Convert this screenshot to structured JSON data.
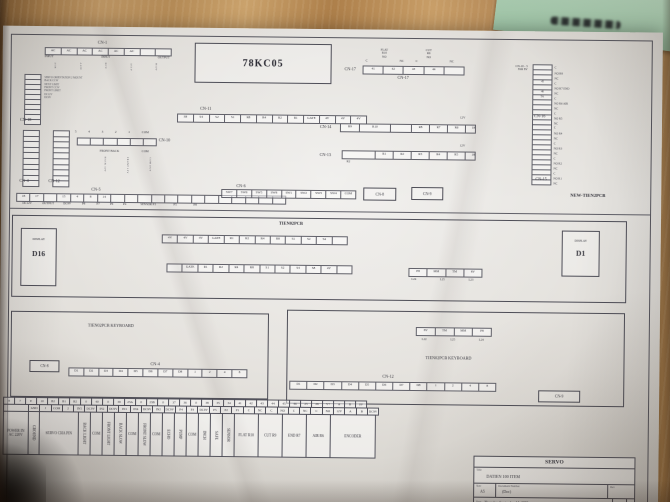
{
  "top": {
    "cn1": {
      "label": "CN-1",
      "cells": [
        "AC",
        "AC",
        "AC",
        "AC",
        "AC",
        "AC",
        "",
        ""
      ],
      "groups": [
        "INPUT",
        "INPUT",
        "OUTPUT"
      ],
      "pins": [
        "ACB",
        "A12V",
        "BCV",
        "AC1V",
        "B12V"
      ]
    },
    "chip": "78KC05",
    "cn18": {
      "label": "CN-18",
      "rows": [
        "",
        "",
        "",
        "",
        "",
        "",
        "",
        "",
        "",
        ""
      ],
      "notes": [
        "SERVO ORIENTATION 2 MOUNT",
        "BACK CCW",
        "NEXT LIMIT",
        "FRONT CCW",
        "FRONT LIMIT",
        "DC12V",
        "DC9V"
      ]
    },
    "cn17": {
      "label_left": "CN-17",
      "label_below": "CN-17",
      "c1": "C",
      "nc1": "NC",
      "c2": "C",
      "nc2": "NC",
      "flat": [
        "FLAT",
        "R10",
        "NO"
      ],
      "cut": [
        "CUT",
        "R6",
        "NO"
      ],
      "cells": [
        "41",
        "42",
        "43",
        "44",
        ""
      ]
    },
    "ssr": [
      "CN-10 - 3",
      "SSR 8V"
    ],
    "cn16": {
      "label": "CN-16",
      "items": [
        {
          "c": "",
          "p": "C"
        },
        {
          "c": "",
          "p": "NO R8"
        },
        {
          "c": "",
          "p": "NC"
        },
        {
          "c": "45",
          "p": "C"
        },
        {
          "c": "",
          "p": "NO R7  END"
        },
        {
          "c": "46",
          "p": "NC"
        },
        {
          "c": "5A",
          "p": "C"
        },
        {
          "c": "",
          "p": "NO R6  AIR"
        },
        {
          "c": "",
          "p": "NC"
        },
        {
          "c": "",
          "p": "C"
        },
        {
          "c": "",
          "p": "NO R5"
        },
        {
          "c": "",
          "p": "NC"
        }
      ]
    },
    "cn15": {
      "label": "CN-15",
      "items": [
        {
          "c": "",
          "p": "C"
        },
        {
          "c": "",
          "p": "NO R4"
        },
        {
          "c": "",
          "p": "NC"
        },
        {
          "c": "",
          "p": "C"
        },
        {
          "c": "",
          "p": "NO R3"
        },
        {
          "c": "",
          "p": "NC"
        },
        {
          "c": "",
          "p": "C"
        },
        {
          "c": "",
          "p": "NO R2"
        },
        {
          "c": "",
          "p": "NC"
        },
        {
          "c": "",
          "p": "C"
        },
        {
          "c": "",
          "p": "NO R1"
        },
        {
          "c": "",
          "p": "NC"
        }
      ]
    },
    "cn11": {
      "label": "CN-11",
      "cells": [
        "S8",
        "S4",
        "S2",
        "S1",
        "R8",
        "R4",
        "R2",
        "R1",
        "GATE",
        "4V",
        "4V",
        "4V"
      ]
    },
    "cn14": {
      "label": "CN-14",
      "v": "12V",
      "cells": [
        {
          "t": "R9",
          "w": 18
        },
        {
          "t": "R10",
          "w": 30
        },
        {
          "t": "",
          "w": 20
        },
        {
          "t": "R8",
          "w": 17
        },
        {
          "t": "R7",
          "w": 17
        },
        {
          "t": "R6",
          "w": 17
        },
        {
          "t": "18",
          "w": 15
        }
      ]
    },
    "cn13": {
      "label": "CN-13",
      "v": "12V",
      "sub": "R2",
      "cells": [
        {
          "t": "",
          "w": 32
        },
        {
          "t": "R1",
          "w": 17
        },
        {
          "t": "R2",
          "w": 17
        },
        {
          "t": "R3",
          "w": 17
        },
        {
          "t": "R4",
          "w": 17
        },
        {
          "t": "R5",
          "w": 17
        },
        {
          "t": "18",
          "w": 15
        }
      ]
    },
    "cn10": {
      "label": "CN-10",
      "nums": [
        "5",
        "4",
        "3",
        "2",
        "1",
        "COM"
      ],
      "cells": [
        "",
        "",
        "",
        "",
        "",
        ""
      ]
    },
    "fb": {
      "front_back": "FRONT BACK",
      "com": "COM",
      "wires": [
        "BACK 12V",
        "FRONT 12V",
        "COM OUT"
      ]
    },
    "cn4t": {
      "label": "CN-4",
      "rows": [
        "",
        "",
        "",
        "",
        "",
        "",
        "",
        "",
        "",
        ""
      ]
    },
    "cn12t": {
      "label": "CN-12",
      "rows": [
        "",
        "",
        "",
        "",
        "",
        "",
        "",
        "",
        "",
        ""
      ]
    },
    "cn5": {
      "label": "CN-5",
      "cells": [
        "18",
        "17",
        "",
        "15",
        "4",
        "8",
        "14",
        "",
        "",
        "",
        "",
        "",
        "",
        "",
        "",
        "",
        "",
        "",
        "",
        ""
      ],
      "tags": [
        {
          "t": "DC12V",
          "w": 22
        },
        {
          "t": "OUTPUT",
          "w": 20
        },
        {
          "t": "DC9V",
          "w": 18
        },
        {
          "t": "P8",
          "w": 15
        },
        {
          "t": "P7",
          "w": 14
        },
        {
          "t": "P6",
          "w": 13
        },
        {
          "t": "P4",
          "w": 13
        },
        {
          "t": "SENSOR P3",
          "w": 34
        },
        {
          "t": "P5",
          "w": 20
        },
        {
          "t": "P8",
          "w": 20
        }
      ]
    },
    "cn6": {
      "label": "CN-6",
      "cells": [
        "SW7",
        "SW6",
        "SW5",
        "SW8",
        "SW1",
        "SW2",
        "SW3",
        "SW4",
        "COM"
      ]
    },
    "cn8_box": "CN-8",
    "cn9_box": "CN-9",
    "board_name": "NEW-TIEN2PCB"
  },
  "mid": {
    "title": "TIEN02PCB",
    "d16_small": "DISPLAY",
    "d16_big": "D16",
    "d1_small": "DISPLAY",
    "d1_big": "D1",
    "rowA": [
      "4V",
      "4V",
      "4V",
      "GATE",
      "R1",
      "R2",
      "R4",
      "R8",
      "S1",
      "S2",
      "S4",
      ""
    ],
    "rowB": [
      "",
      "GATE",
      "R1",
      "R2",
      "R4",
      "R8",
      "S1",
      "S2",
      "S4",
      "S8",
      "4V",
      ""
    ],
    "mini_cells": [
      "P8",
      "MM",
      "TM",
      "8V"
    ],
    "mini_tags": [
      "L24",
      "L25",
      "L23"
    ]
  },
  "kbl": {
    "title": "TIEN02PCB KEYBOARD",
    "cn8_box": "CN-8",
    "cn4_label": "CN-4",
    "cn4_cells": [
      "D1",
      "D2",
      "D3",
      "D4",
      "D5",
      "D6",
      "D7",
      "D8",
      "1",
      "2",
      "4",
      "8"
    ]
  },
  "kbr": {
    "title": "TIEN02PCB KEYBOARD",
    "mini_cells": [
      "8V",
      "TM",
      "MM",
      "P8"
    ],
    "mini_tags": [
      "L22",
      "L25",
      "L24"
    ],
    "cn12_label": "CN-12",
    "cn12_cells": [
      "D1",
      "D2",
      "D3",
      "D4",
      "D5",
      "D6",
      "D7",
      "D8",
      "1",
      "2",
      "4",
      "8"
    ],
    "cn9_box": "CN-9"
  },
  "btable": {
    "row1": [
      "8",
      "7",
      "E",
      "10",
      "B2",
      "B1",
      "B2",
      "0",
      "40",
      "0",
      "39",
      "23A",
      "0",
      "23B",
      "0",
      "37",
      "36",
      "0",
      "38",
      "35",
      "34",
      "41",
      "42",
      "43",
      "44",
      "45",
      "46",
      "25",
      "26",
      "V+",
      "A",
      "B",
      "0V"
    ],
    "row2": [
      {
        "t": "",
        "w": 26
      },
      "GND",
      "J",
      "COM",
      "2",
      "IN5",
      "DC9V",
      "IN2",
      "DC9V",
      "IN1",
      "IN4",
      "DC9V",
      "IN2",
      "DC9V",
      "P4",
      "P3",
      "DC9V",
      "P5",
      "P2",
      "P1",
      "C",
      "NC",
      "C",
      "NO",
      "C",
      "NC",
      "C",
      "NO",
      "12V",
      "A",
      "B",
      "DC9V"
    ],
    "row3": [
      {
        "t": "POWER IN AC 220V",
        "w": 26
      },
      {
        "t": "GROUND",
        "w": 12,
        "r": 1
      },
      {
        "t": "SERVO CHA PIN",
        "w": 40
      },
      {
        "t": "BACK LIGHT",
        "w": 13,
        "r": 1
      },
      {
        "t": "COM",
        "w": 13
      },
      {
        "t": "FRONT LIGHT",
        "w": 13,
        "r": 1
      },
      {
        "t": "BACK SLOW",
        "w": 13,
        "r": 1
      },
      {
        "t": "COM",
        "w": 13
      },
      {
        "t": "FRONT SLOW",
        "w": 13,
        "r": 1
      },
      {
        "t": "COM",
        "w": 13
      },
      {
        "t": "ECHO",
        "w": 13,
        "r": 1
      },
      {
        "t": "PUMP",
        "w": 13,
        "r": 1
      },
      {
        "t": "COM",
        "w": 13
      },
      {
        "t": "INCH",
        "w": 13,
        "r": 1
      },
      {
        "t": "SAFE",
        "w": 13,
        "r": 1
      },
      {
        "t": "SENSOR",
        "w": 13,
        "r": 1
      },
      {
        "t": "FLAT R10",
        "w": 25
      },
      {
        "t": "CUT R9",
        "w": 25
      },
      {
        "t": "END R7",
        "w": 25
      },
      {
        "t": "AIR R6",
        "w": 25
      },
      {
        "t": "ENCODER",
        "w": 46
      }
    ]
  },
  "tb": {
    "header": "SERVO",
    "title_label": "Title",
    "title": "DATIEN 100 ITEM",
    "size_label": "Size",
    "size": "A5",
    "doc_label": "Document Number",
    "doc": "(Doc)",
    "rev_label": "Rev",
    "date_label": "Date",
    "date": "Thursday, September 14, 2000",
    "sheet_label": "Sheet",
    "of_label": "of"
  }
}
